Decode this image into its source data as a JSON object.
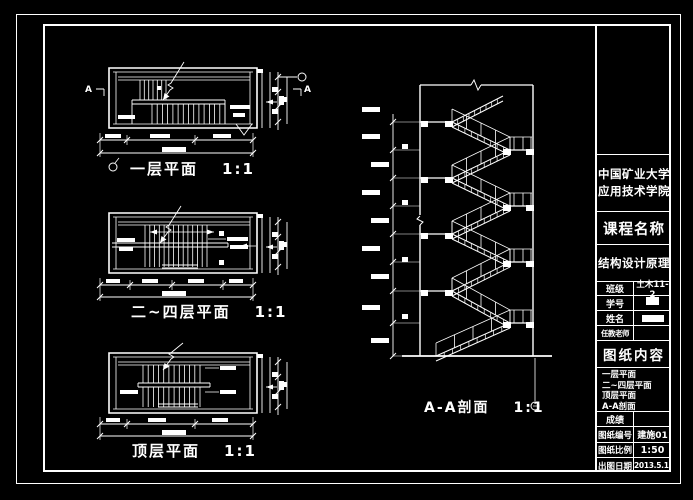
{
  "sheet": {
    "background": "#000000",
    "line_color": "#ffffff",
    "plans": [
      {
        "label": "一层平面",
        "scale": "1:1"
      },
      {
        "label": "二~四层平面",
        "scale": "1:1"
      },
      {
        "label": "顶层平面",
        "scale": "1:1"
      }
    ],
    "section": {
      "label": "A-A剖面",
      "scale": "1:1"
    },
    "section_markers": {
      "left": "A",
      "right": "A"
    }
  },
  "title_block": {
    "school_line1": "中国矿业大学",
    "school_line2": "应用技术学院",
    "course_label": "课程名称",
    "course_name": "结构设计原理",
    "info_rows": [
      {
        "label": "班级",
        "value": "土木11-2"
      },
      {
        "label": "学号",
        "value": ""
      },
      {
        "label": "姓名",
        "value": ""
      },
      {
        "label": "任教老师",
        "value": ""
      }
    ],
    "content_label": "图纸内容",
    "content_items": [
      "一层平面",
      "二~四层平面",
      "顶层平面",
      "A-A剖面"
    ],
    "grade_label": "成绩",
    "footer_rows": [
      {
        "label": "图纸编号",
        "value": "建施01"
      },
      {
        "label": "图纸比例",
        "value": "1:50"
      },
      {
        "label": "出图日期",
        "value": "2013.5.16"
      }
    ]
  }
}
